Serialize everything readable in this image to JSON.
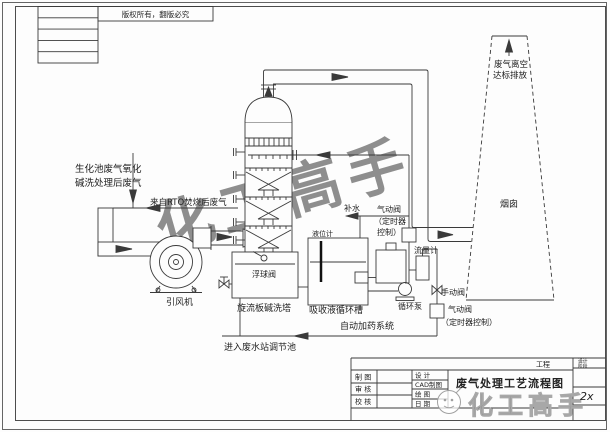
{
  "frame": {
    "copyright": "版权所有，翻版必究"
  },
  "labels": {
    "inlet_line1": "生化池废气氧化",
    "inlet_line2": "碱洗处理后废气",
    "rto_gas": "来自RTO焚烧后废气",
    "fan": "引风机",
    "tower": "旋流板碱洗塔",
    "float_valve": "浮球阀",
    "level_gauge": "液位计",
    "circulation_tank": "吸收液循环槽",
    "dosing_system": "自动加药系统",
    "circulation_pump": "循环泵",
    "makeup_water": "补水",
    "pneumatic_valve_1a": "气动阀",
    "pneumatic_valve_1b": "（定时器",
    "pneumatic_valve_1c": "控制）",
    "flow_meter": "流量计",
    "manual_valve": "手动阀",
    "pneumatic_valve_2a": "气动阀",
    "pneumatic_valve_2b": "（定时器控制）",
    "drain_to_wastewater": "进入废水站调节池",
    "stack_exhaust_line1": "废气离空",
    "stack_exhaust_line2": "达标排放",
    "stack": "烟囱"
  },
  "title_block": {
    "project_label": "工程",
    "drawing_title": "废气处理工艺流程图",
    "left_rows": [
      "制 图",
      "审 核",
      "校 核"
    ],
    "mid_rows": [
      "设 计",
      "CAD制图",
      "绘 图",
      "日 期"
    ],
    "stage_line1": "设计",
    "stage_line2": "阶段",
    "handwritten_note": "2x",
    "watermark": "化工高手"
  },
  "watermark_diagonal": "化工高手",
  "colors": {
    "line": "#3a3a3a",
    "watermark_gray": "#dcdcdc",
    "logo_gray": "#a0a0a0"
  }
}
